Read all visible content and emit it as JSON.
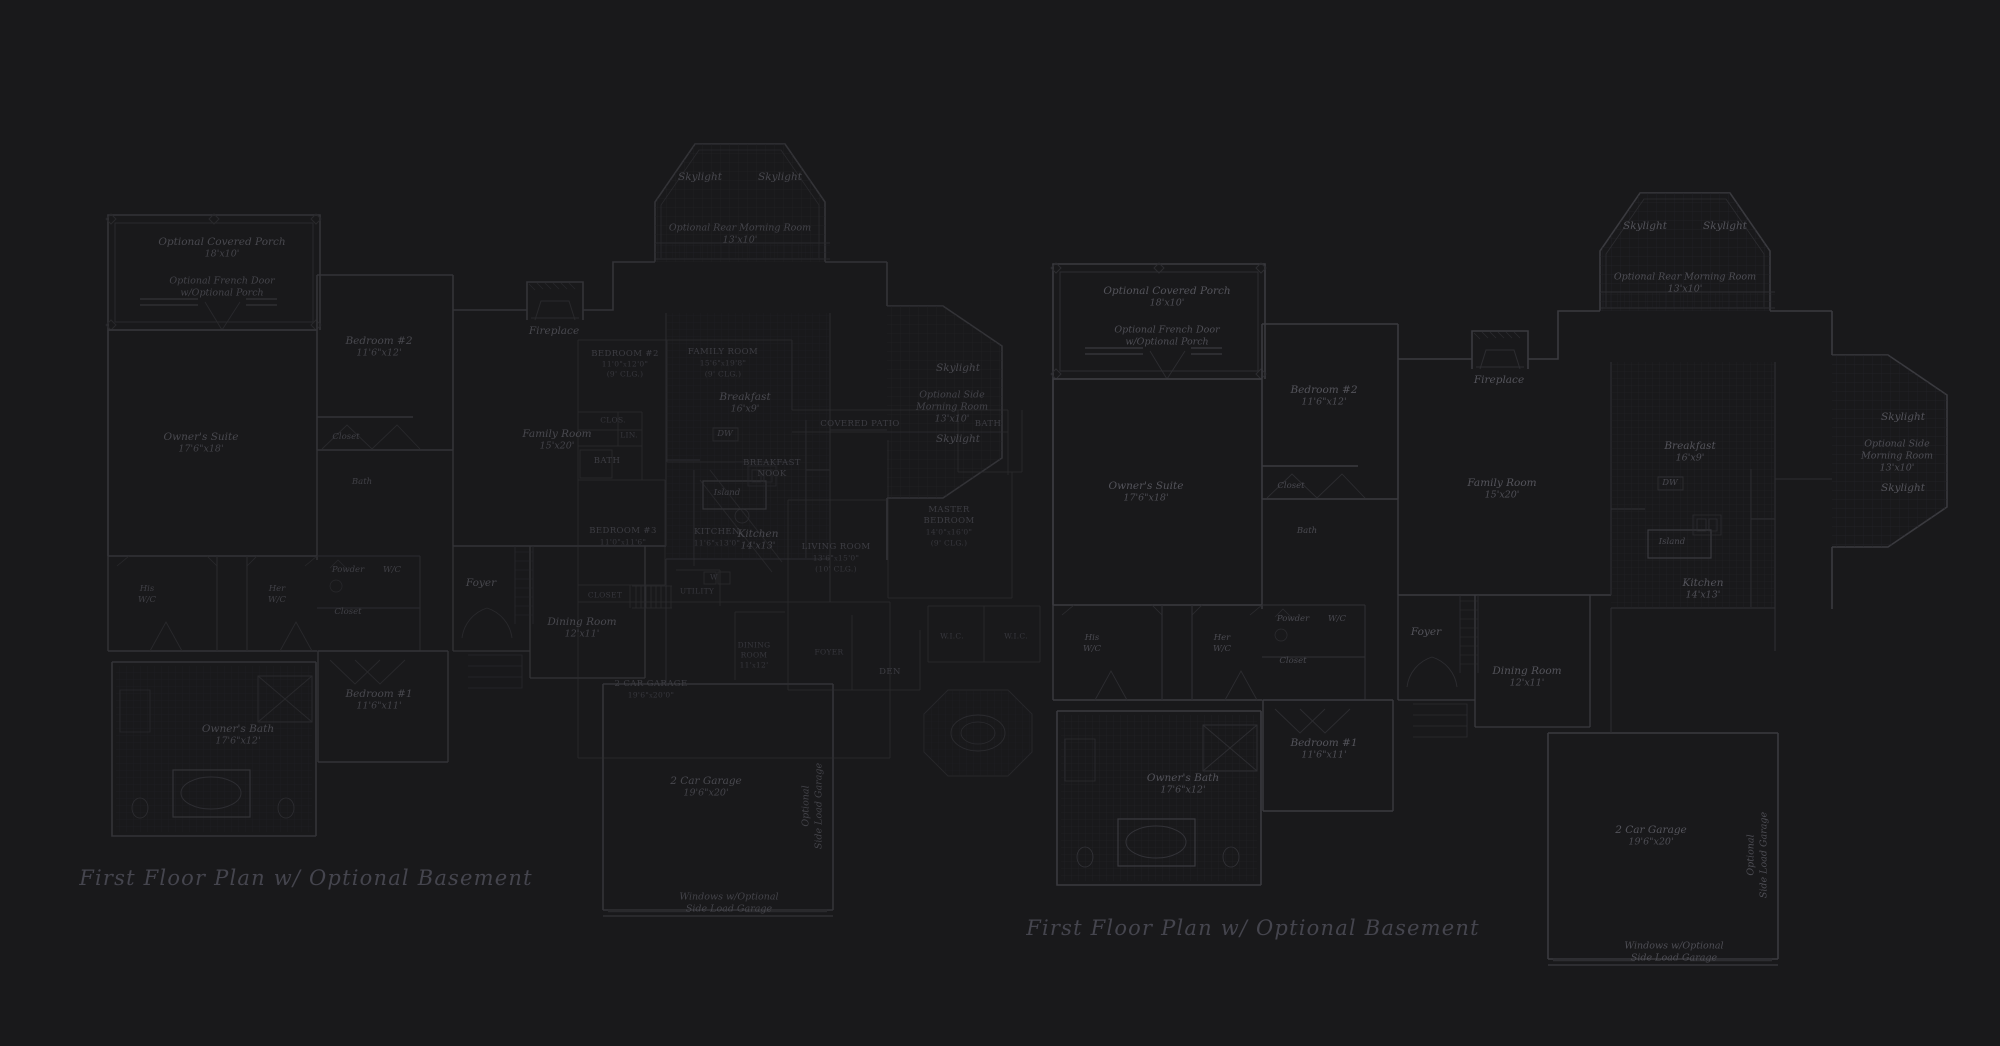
{
  "colors": {
    "background": "#19191b",
    "wall": "#3a3a3f",
    "wall_dim": "#2d2d31",
    "grid": "#232327",
    "fixture": "#333338",
    "italic_text": "#54545b",
    "caps_text": "#3d3d43",
    "title_text": "#45454e"
  },
  "plans": [
    {
      "id": "left-floor-plan",
      "dx": 0,
      "dy": 0,
      "title": "First Floor Plan  w/ Optional Basement",
      "tx": 306,
      "ty": 878
    },
    {
      "id": "right-floor-plan",
      "dx": 945,
      "dy": 49,
      "title": "First Floor Plan  w/ Optional Basement",
      "tx": 1253,
      "ty": 928
    }
  ],
  "italic_labels": [
    {
      "t": "Optional Covered Porch",
      "x": 222,
      "y": 242,
      "cls": "it"
    },
    {
      "t": "18'x10'",
      "x": 222,
      "y": 254,
      "cls": "itd"
    },
    {
      "t": "Optional French Door",
      "x": 222,
      "y": 281,
      "cls": "itd"
    },
    {
      "t": "w/Optional Porch",
      "x": 222,
      "y": 293,
      "cls": "itd"
    },
    {
      "t": "Skylight",
      "x": 700,
      "y": 177,
      "cls": "it"
    },
    {
      "t": "Skylight",
      "x": 780,
      "y": 177,
      "cls": "it"
    },
    {
      "t": "Optional Rear Morning Room",
      "x": 740,
      "y": 228,
      "cls": "itd"
    },
    {
      "t": "13'x10'",
      "x": 740,
      "y": 240,
      "cls": "itd"
    },
    {
      "t": "Bedroom #2",
      "x": 379,
      "y": 341,
      "cls": "it"
    },
    {
      "t": "11'6\"x12'",
      "x": 379,
      "y": 353,
      "cls": "itd"
    },
    {
      "t": "Closet",
      "x": 346,
      "y": 437,
      "cls": "itsm"
    },
    {
      "t": "Fireplace",
      "x": 554,
      "y": 331,
      "cls": "it"
    },
    {
      "t": "Family Room",
      "x": 557,
      "y": 434,
      "cls": "it"
    },
    {
      "t": "15'x20'",
      "x": 557,
      "y": 446,
      "cls": "itd"
    },
    {
      "t": "Owner's Suite",
      "x": 201,
      "y": 437,
      "cls": "it"
    },
    {
      "t": "17'6\"x18'",
      "x": 201,
      "y": 449,
      "cls": "itd"
    },
    {
      "t": "Bath",
      "x": 362,
      "y": 482,
      "cls": "itsm"
    },
    {
      "t": "Skylight",
      "x": 958,
      "y": 368,
      "cls": "it"
    },
    {
      "t": "Optional Side",
      "x": 952,
      "y": 395,
      "cls": "itd"
    },
    {
      "t": "Morning Room",
      "x": 952,
      "y": 407,
      "cls": "itd"
    },
    {
      "t": "13'x10'",
      "x": 952,
      "y": 419,
      "cls": "itd"
    },
    {
      "t": "Skylight",
      "x": 958,
      "y": 439,
      "cls": "it"
    },
    {
      "t": "Breakfast",
      "x": 745,
      "y": 397,
      "cls": "it"
    },
    {
      "t": "16'x9'",
      "x": 745,
      "y": 409,
      "cls": "itd"
    },
    {
      "t": "DW",
      "x": 725,
      "y": 434,
      "cls": "itsm"
    },
    {
      "t": "Island",
      "x": 727,
      "y": 493,
      "cls": "itsm"
    },
    {
      "t": "Kitchen",
      "x": 758,
      "y": 534,
      "cls": "it"
    },
    {
      "t": "14'x13'",
      "x": 758,
      "y": 546,
      "cls": "itd"
    },
    {
      "t": "Powder",
      "x": 348,
      "y": 570,
      "cls": "itsm"
    },
    {
      "t": "W/C",
      "x": 392,
      "y": 570,
      "cls": "itsm"
    },
    {
      "t": "Closet",
      "x": 348,
      "y": 612,
      "cls": "itsm"
    },
    {
      "t": "Foyer",
      "x": 481,
      "y": 583,
      "cls": "it"
    },
    {
      "t": "Dining Room",
      "x": 582,
      "y": 622,
      "cls": "it"
    },
    {
      "t": "12'x11'",
      "x": 582,
      "y": 634,
      "cls": "itd"
    },
    {
      "t": "His",
      "x": 147,
      "y": 589,
      "cls": "itsm"
    },
    {
      "t": "W/C",
      "x": 147,
      "y": 600,
      "cls": "itsm"
    },
    {
      "t": "Her",
      "x": 277,
      "y": 589,
      "cls": "itsm"
    },
    {
      "t": "W/C",
      "x": 277,
      "y": 600,
      "cls": "itsm"
    },
    {
      "t": "Bedroom #1",
      "x": 379,
      "y": 694,
      "cls": "it"
    },
    {
      "t": "11'6\"x11'",
      "x": 379,
      "y": 706,
      "cls": "itd"
    },
    {
      "t": "Owner's Bath",
      "x": 238,
      "y": 729,
      "cls": "it"
    },
    {
      "t": "17'6\"x12'",
      "x": 238,
      "y": 741,
      "cls": "itd"
    },
    {
      "t": "2 Car Garage",
      "x": 706,
      "y": 781,
      "cls": "it"
    },
    {
      "t": "19'6\"x20'",
      "x": 706,
      "y": 793,
      "cls": "itd"
    },
    {
      "t": "Optional",
      "x": 806,
      "y": 806,
      "cls": "vert"
    },
    {
      "t": "Side Load Garage",
      "x": 819,
      "y": 806,
      "cls": "vert"
    },
    {
      "t": "Windows w/Optional",
      "x": 729,
      "y": 897,
      "cls": "itd"
    },
    {
      "t": "Side Load Garage",
      "x": 729,
      "y": 909,
      "cls": "itd"
    }
  ],
  "caps_labels": [
    {
      "t": "BEDROOM #2",
      "x": 625,
      "y": 354,
      "cls": "caps"
    },
    {
      "t": "11'0\"x12'0\"",
      "x": 625,
      "y": 364,
      "cls": "capsd"
    },
    {
      "t": "(9' CLG.)",
      "x": 625,
      "y": 374,
      "cls": "capsd"
    },
    {
      "t": "FAMILY ROOM",
      "x": 723,
      "y": 352,
      "cls": "caps"
    },
    {
      "t": "15'6\"x19'8\"",
      "x": 723,
      "y": 363,
      "cls": "capsd"
    },
    {
      "t": "(9' CLG.)",
      "x": 723,
      "y": 374,
      "cls": "capsd"
    },
    {
      "t": "CLOS.",
      "x": 613,
      "y": 420,
      "cls": "capsd"
    },
    {
      "t": "LIN.",
      "x": 629,
      "y": 435,
      "cls": "capsd"
    },
    {
      "t": "BATH",
      "x": 607,
      "y": 461,
      "cls": "caps"
    },
    {
      "t": "BEDROOM #3",
      "x": 623,
      "y": 531,
      "cls": "caps"
    },
    {
      "t": "11'0\"x11'6\"",
      "x": 623,
      "y": 542,
      "cls": "capsd"
    },
    {
      "t": "BREAKFAST",
      "x": 772,
      "y": 463,
      "cls": "caps"
    },
    {
      "t": "NOOK",
      "x": 772,
      "y": 474,
      "cls": "caps"
    },
    {
      "t": "KITCHEN",
      "x": 717,
      "y": 532,
      "cls": "caps"
    },
    {
      "t": "11'6\"x13'0\"",
      "x": 717,
      "y": 543,
      "cls": "capsd"
    },
    {
      "t": "UTILITY",
      "x": 697,
      "y": 591,
      "cls": "capsd"
    },
    {
      "t": "W",
      "x": 714,
      "y": 577,
      "cls": "capsd"
    },
    {
      "t": "CLOSET",
      "x": 605,
      "y": 595,
      "cls": "capsd"
    },
    {
      "t": "2 CAR GARAGE",
      "x": 651,
      "y": 684,
      "cls": "caps"
    },
    {
      "t": "19'6\"x20'0\"",
      "x": 651,
      "y": 695,
      "cls": "capsd"
    },
    {
      "t": "DINING",
      "x": 754,
      "y": 645,
      "cls": "capsd"
    },
    {
      "t": "ROOM",
      "x": 754,
      "y": 655,
      "cls": "capsd"
    },
    {
      "t": "11'x12'",
      "x": 754,
      "y": 665,
      "cls": "capsd"
    },
    {
      "t": "FOYER",
      "x": 829,
      "y": 652,
      "cls": "capsd"
    },
    {
      "t": "DEN",
      "x": 890,
      "y": 672,
      "cls": "caps"
    },
    {
      "t": "LIVING ROOM",
      "x": 836,
      "y": 547,
      "cls": "caps"
    },
    {
      "t": "13'6\"x15'0\"",
      "x": 836,
      "y": 558,
      "cls": "capsd"
    },
    {
      "t": "(10' CLG.)",
      "x": 836,
      "y": 569,
      "cls": "capsd"
    },
    {
      "t": "MASTER",
      "x": 949,
      "y": 510,
      "cls": "caps"
    },
    {
      "t": "BEDROOM",
      "x": 949,
      "y": 521,
      "cls": "caps"
    },
    {
      "t": "14'0\"x16'0\"",
      "x": 949,
      "y": 532,
      "cls": "capsd"
    },
    {
      "t": "(9' CLG.)",
      "x": 949,
      "y": 543,
      "cls": "capsd"
    },
    {
      "t": "COVERED PATIO",
      "x": 860,
      "y": 424,
      "cls": "caps"
    },
    {
      "t": "BATH",
      "x": 988,
      "y": 424,
      "cls": "caps"
    },
    {
      "t": "W.I.C.",
      "x": 952,
      "y": 636,
      "cls": "capsd"
    },
    {
      "t": "W.I.C.",
      "x": 1016,
      "y": 636,
      "cls": "capsd"
    }
  ]
}
